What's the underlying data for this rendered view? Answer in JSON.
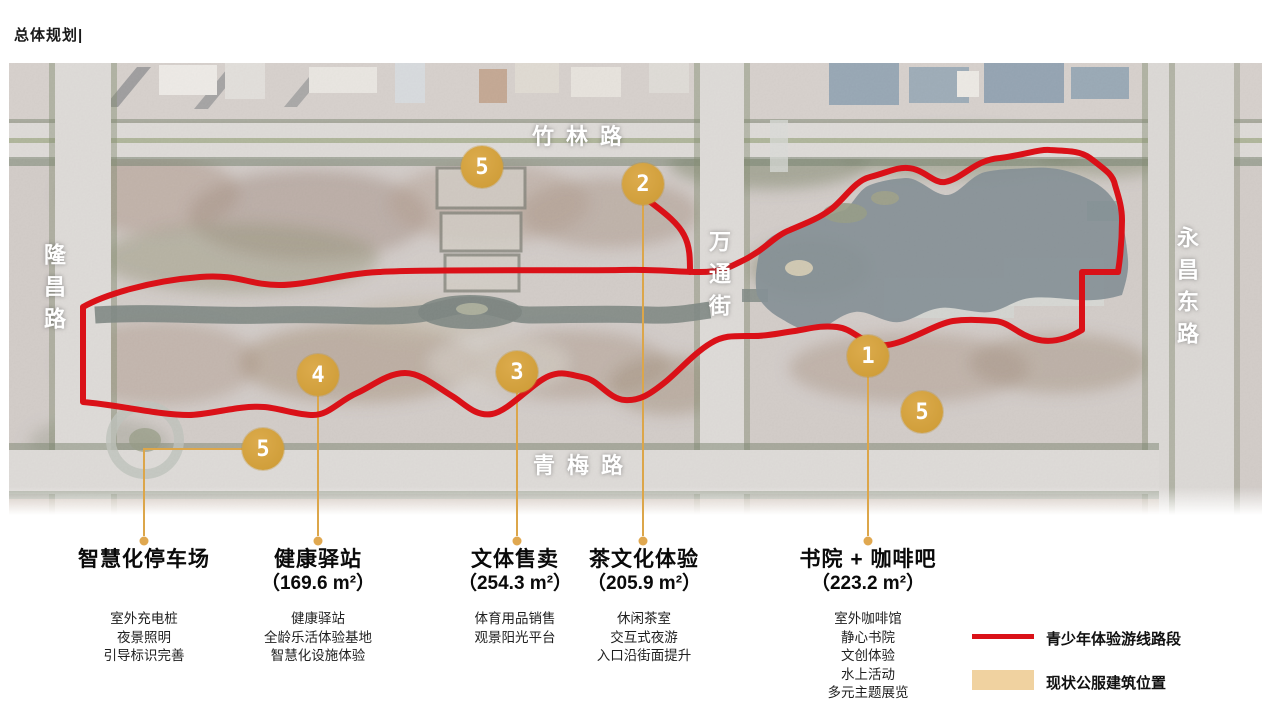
{
  "page_title": "总体规划|",
  "map": {
    "roads": {
      "top": "竹林路",
      "left": "隆昌路",
      "middle": "万通街",
      "right": "永昌东路",
      "bottom": "青梅路"
    },
    "markers": [
      {
        "n": "5"
      },
      {
        "n": "2"
      },
      {
        "n": "4"
      },
      {
        "n": "3"
      },
      {
        "n": "1"
      },
      {
        "n": "5"
      },
      {
        "n": "5"
      }
    ],
    "route_color": "#da1118",
    "marker_color": "#d2a23f",
    "leader_color": "#dca64a"
  },
  "annotations": [
    {
      "title": "智慧化停车场",
      "area": "",
      "items": [
        "室外充电桩",
        "夜景照明",
        "引导标识完善"
      ]
    },
    {
      "title": "健康驿站",
      "area": "（169.6 m²）",
      "items": [
        "健康驿站",
        "全龄乐活体验基地",
        "智慧化设施体验"
      ]
    },
    {
      "title": "文体售卖",
      "area": "（254.3 m²）",
      "items": [
        "体育用品销售",
        "观景阳光平台"
      ]
    },
    {
      "title": "茶文化体验",
      "area": "（205.9 m²）",
      "items": [
        "休闲茶室",
        "交互式夜游",
        "入口沿街面提升"
      ]
    },
    {
      "title": "书院 + 咖啡吧",
      "area": "（223.2 m²）",
      "items": [
        "室外咖啡馆",
        "静心书院",
        "文创体验",
        "水上活动",
        "多元主题展览"
      ]
    }
  ],
  "legend": {
    "route_label": "青少年体验游线路段",
    "building_label": "现状公服建筑位置",
    "building_color": "#f0d2a0"
  }
}
